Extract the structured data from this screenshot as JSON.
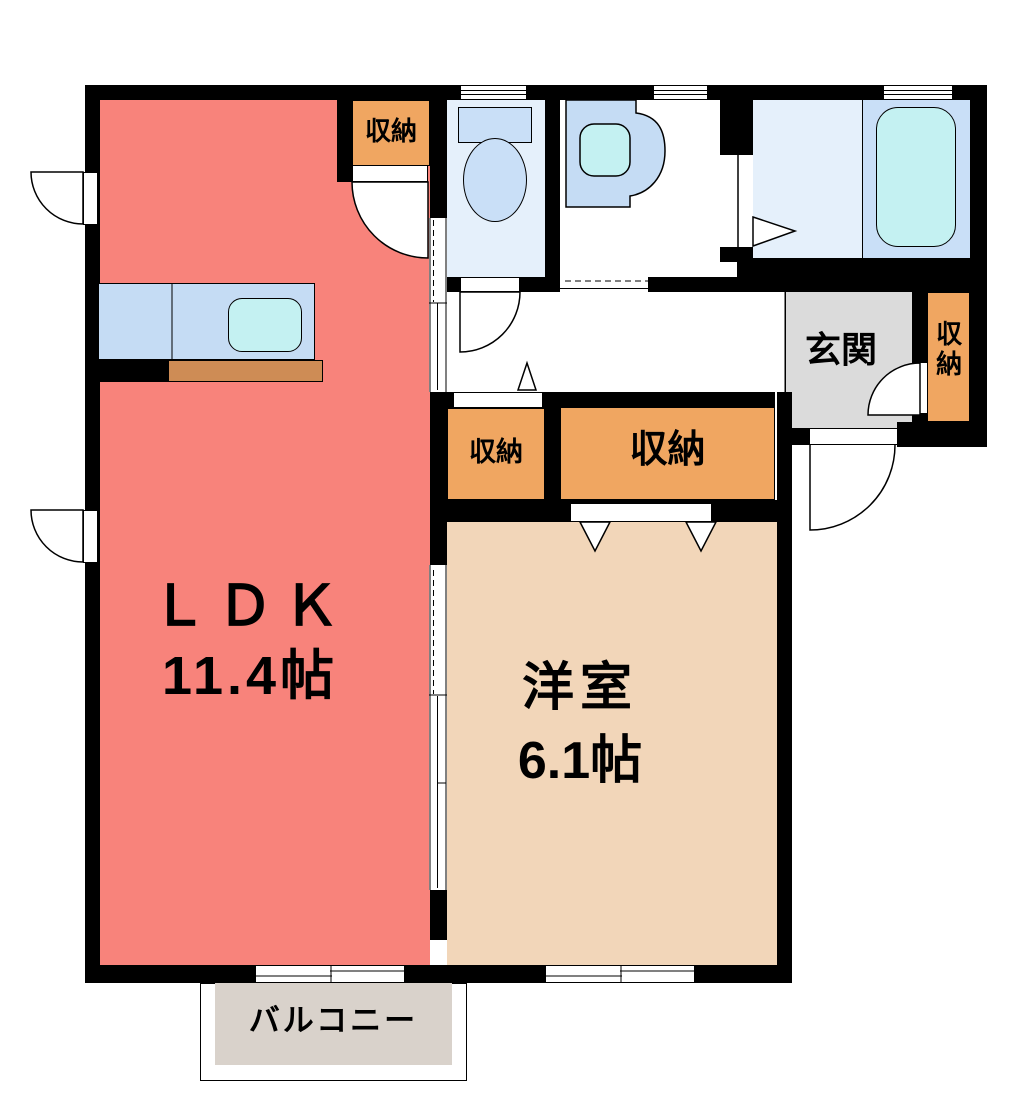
{
  "rooms": {
    "ldk": {
      "name": "ＬＤＫ",
      "area": "11.4帖"
    },
    "western": {
      "name": "洋室",
      "area": "6.1帖"
    },
    "entrance": {
      "name": "玄関"
    },
    "balcony": {
      "name": "バルコニー"
    },
    "storage": {
      "name": "収納"
    }
  },
  "colors": {
    "ldk": "#F8837B",
    "western": "#F2D6B9",
    "storage": "#F0A661",
    "entrance_floor": "#DBDBDB",
    "balcony_floor": "#D9D2CB",
    "wet_floor": "#E5F0FB",
    "fixture_blue": "#C9DFF7",
    "counter_blue": "#C5DCF4",
    "aqua": "#C4F1F2",
    "wood": "#CE8C55",
    "wall": "#000000"
  }
}
